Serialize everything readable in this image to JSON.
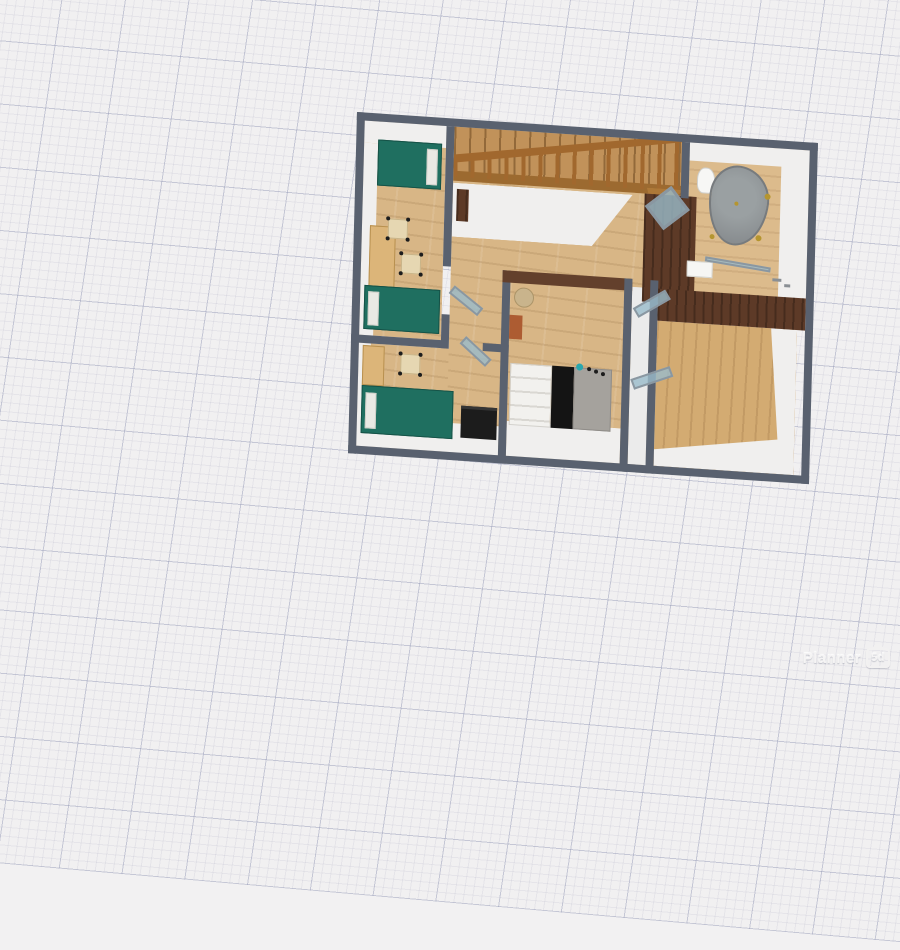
{
  "app": {
    "name": "Planner 5D",
    "watermark_text": "Planner",
    "watermark_badge": "5d"
  },
  "palette": {
    "canvas_background": "#f1f0f1",
    "grid_minor_line": "#e4e4ec",
    "grid_major_line": "#c5c9dc",
    "wall_top": "#59616f",
    "wall_face_white": "#f0efee",
    "floor_wood": "#d8b686",
    "dark_wood_wall": "#5e3b29",
    "stair_tread_wood": "#c1925a",
    "railing_wood": "#a1682e",
    "bed_teal": "#1f6f60",
    "desk_wood": "#dcb579",
    "chair_beige": "#e6d7b2",
    "black_cabinet": "#1c1c1c",
    "bathtub_gray": "#8d9093",
    "glass_blue": "#9abccb",
    "gold_fixture": "#b5952f",
    "sofa_white": "#f2f1ee",
    "sofa_gray": "#a5a29d",
    "wall_art_orange": "#ad5c32"
  },
  "scene": {
    "view": "3d-floor-plan-top-view",
    "rooms": [
      {
        "name": "bedroom-top-left",
        "furniture": [
          "teal bed",
          "teal bed",
          "wooden desk",
          "chair",
          "chair",
          "glass door"
        ]
      },
      {
        "name": "bedroom-bottom-left",
        "furniture": [
          "teal bed",
          "wooden wardrobe",
          "chair",
          "black cabinet",
          "glass door"
        ]
      },
      {
        "name": "hallway",
        "furniture": [
          "wooden staircase",
          "stair railing",
          "newel chest"
        ]
      },
      {
        "name": "center-bedroom",
        "furniture": [
          "bed white-black-gray",
          "round side table",
          "orange wall art",
          "wall decor dots"
        ]
      },
      {
        "name": "corridor-right",
        "furniture": [
          "glass door",
          "glass door"
        ]
      },
      {
        "name": "bathroom-top-right",
        "furniture": [
          "bathtub",
          "toilet",
          "sink cabinet",
          "shower glass",
          "brown wardrobe",
          "glass door"
        ]
      },
      {
        "name": "room-bottom-right",
        "furniture": []
      }
    ]
  }
}
